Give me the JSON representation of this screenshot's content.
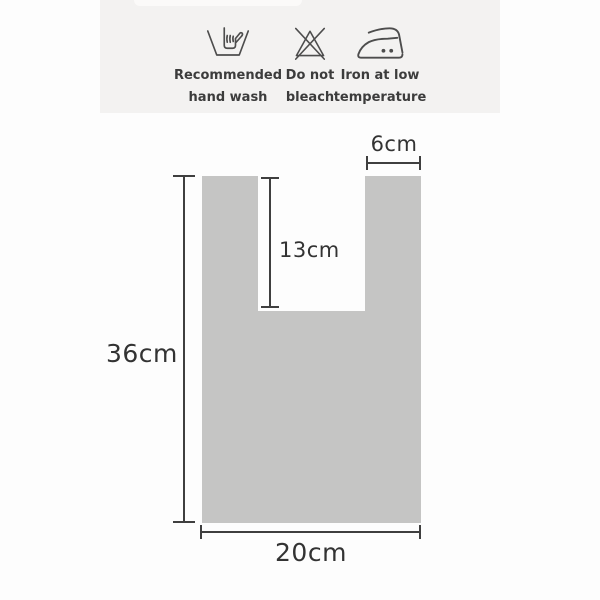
{
  "page": {
    "background_color": "#fdfdfd",
    "type": "product-spec-image"
  },
  "care_panel": {
    "background_color": "#f3f2f1",
    "icon_color": "#4d4d4d",
    "label_color": "#3c3c3c",
    "items": [
      {
        "icon": "hand-wash-icon",
        "label1": "Recommended",
        "label2": "hand wash"
      },
      {
        "icon": "do-not-bleach-icon",
        "label1": "Do not",
        "label2": "bleach"
      },
      {
        "icon": "iron-low-temp-icon",
        "label1": "Iron at low",
        "label2": "temperature"
      }
    ]
  },
  "diagram": {
    "bag_fill_color": "#c5c5c4",
    "notch_fill_color": "#fdfdfd",
    "dimension_line_color": "#3f3f3f",
    "dimension_text_color": "#333333",
    "dimensions": {
      "total_height": "36cm",
      "bottom_width": "20cm",
      "handle_opening_depth": "13cm",
      "strap_width": "6cm"
    }
  }
}
